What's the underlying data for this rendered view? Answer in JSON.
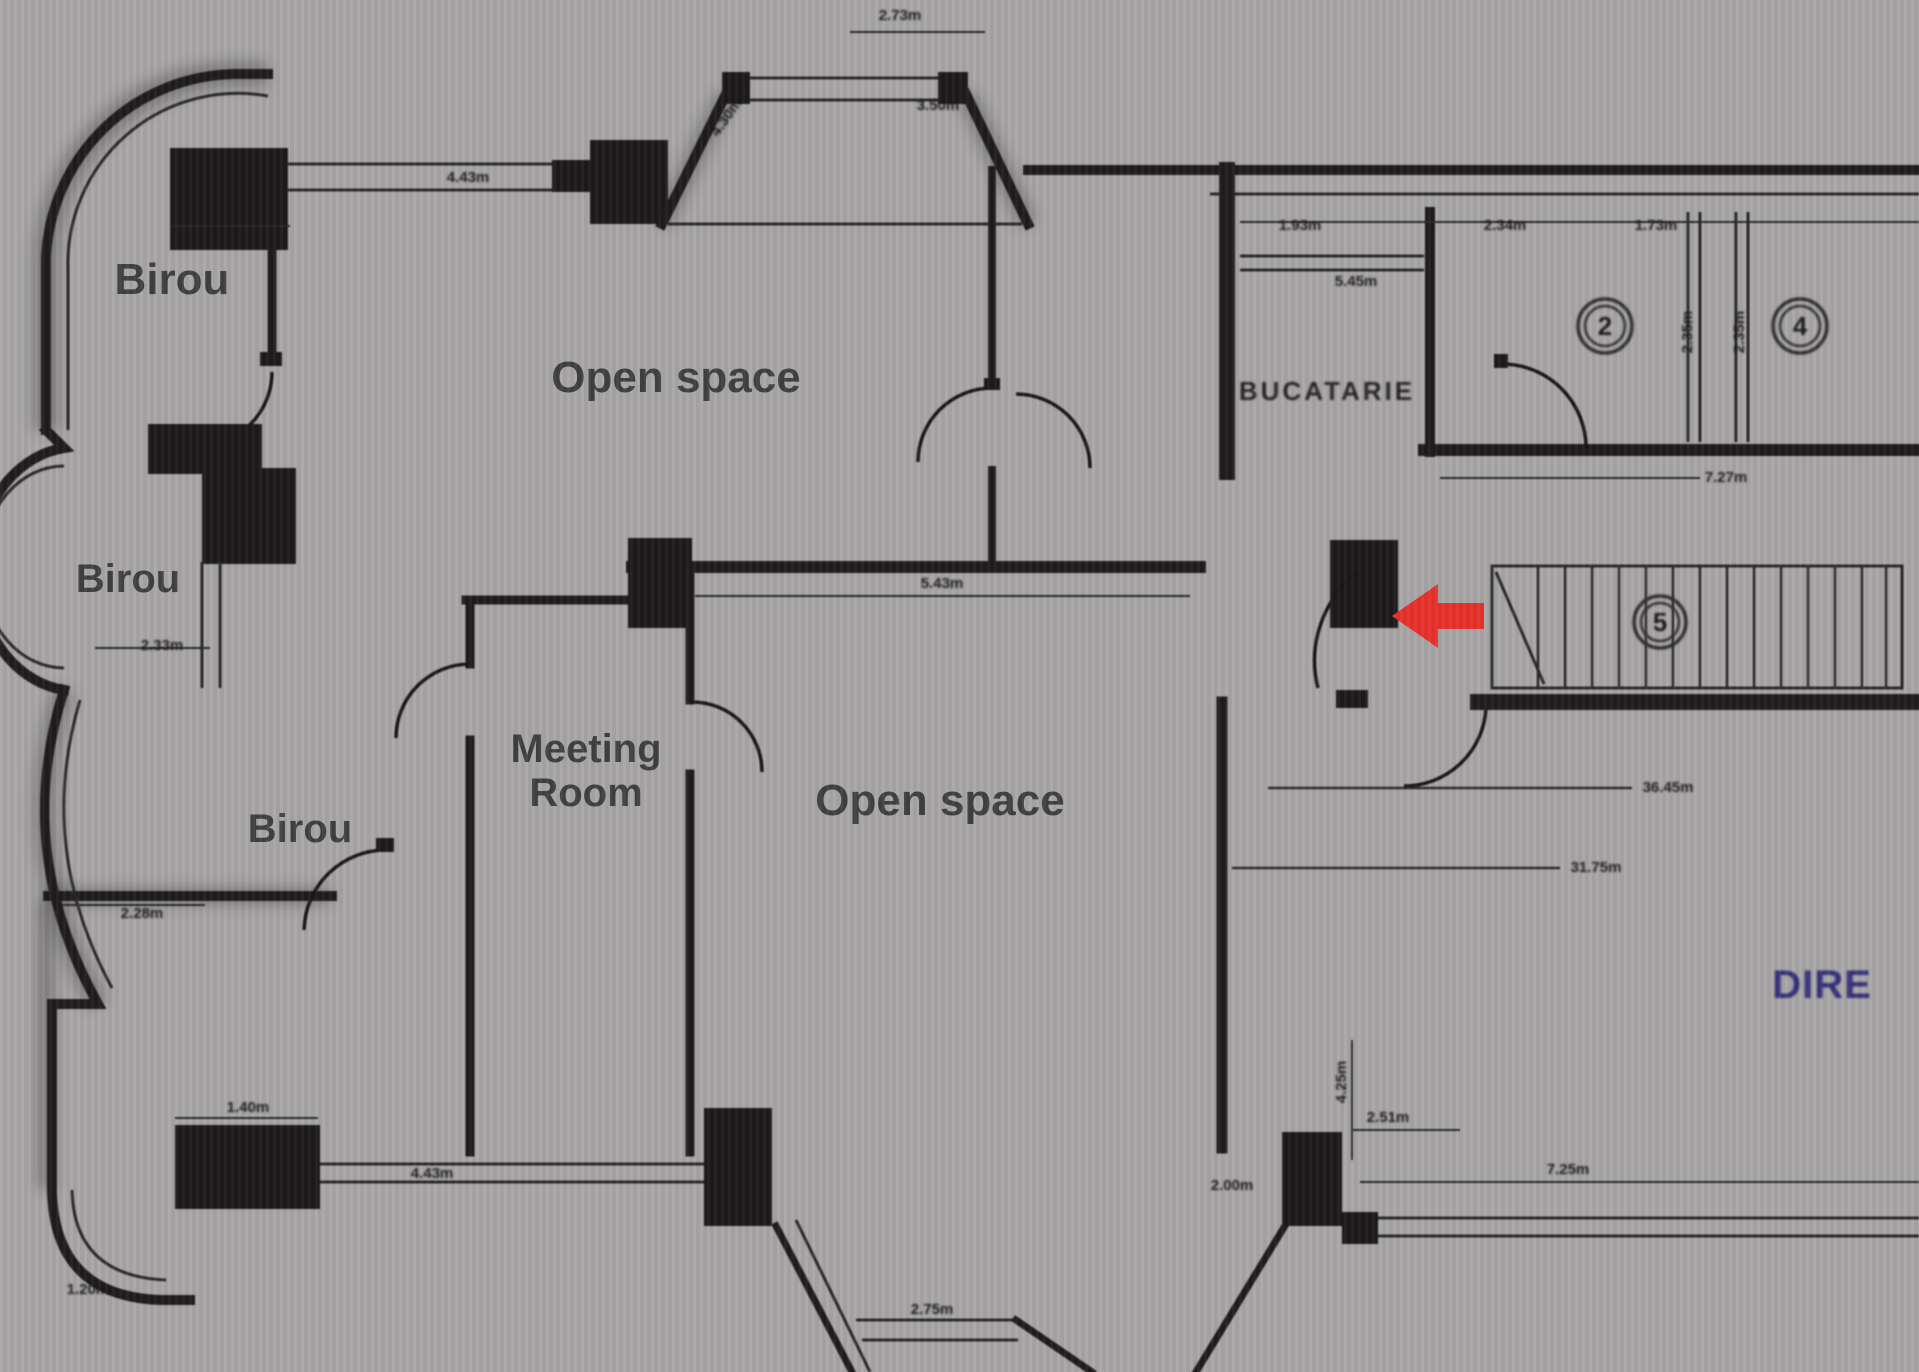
{
  "document": {
    "kind": "scanned-floor-plan",
    "background_color": "#a8a6a7",
    "wall_color": "#232021",
    "annotation_arrow_color": "#e8312a",
    "watermark_color": "#36307a"
  },
  "room_labels": [
    {
      "text": "Birou"
    },
    {
      "text": "Open space"
    },
    {
      "text": "Birou"
    },
    {
      "text": "Meeting"
    },
    {
      "text": "Room"
    },
    {
      "text": "Birou"
    },
    {
      "text": "Open space"
    }
  ],
  "scan_labels": {
    "kitchen": "BUCATARIE"
  },
  "room_numbers": [
    {
      "value": "2"
    },
    {
      "value": "4"
    },
    {
      "value": "5"
    }
  ],
  "dimensions": [
    {
      "text": "1.40m"
    },
    {
      "text": "4.43m"
    },
    {
      "text": "4.30m"
    },
    {
      "text": "2.73m"
    },
    {
      "text": "3.50m"
    },
    {
      "text": "1.93m"
    },
    {
      "text": "5.45m"
    },
    {
      "text": "2.34m"
    },
    {
      "text": "1.73m"
    },
    {
      "text": "2.35m"
    },
    {
      "text": "2.35m"
    },
    {
      "text": "7.27m"
    },
    {
      "text": "5.43m"
    },
    {
      "text": "36.45m"
    },
    {
      "text": "31.75m"
    },
    {
      "text": "2.33m"
    },
    {
      "text": "2.28m"
    },
    {
      "text": "1.40m"
    },
    {
      "text": "4.43m"
    },
    {
      "text": "1.20m"
    },
    {
      "text": "2.75m"
    },
    {
      "text": "4.25m"
    },
    {
      "text": "2.51m"
    },
    {
      "text": "7.25m"
    },
    {
      "text": "2.00m"
    }
  ],
  "watermark": {
    "text": "DIRE"
  },
  "annotations": {
    "red_arrow": "points-left-at-door"
  }
}
